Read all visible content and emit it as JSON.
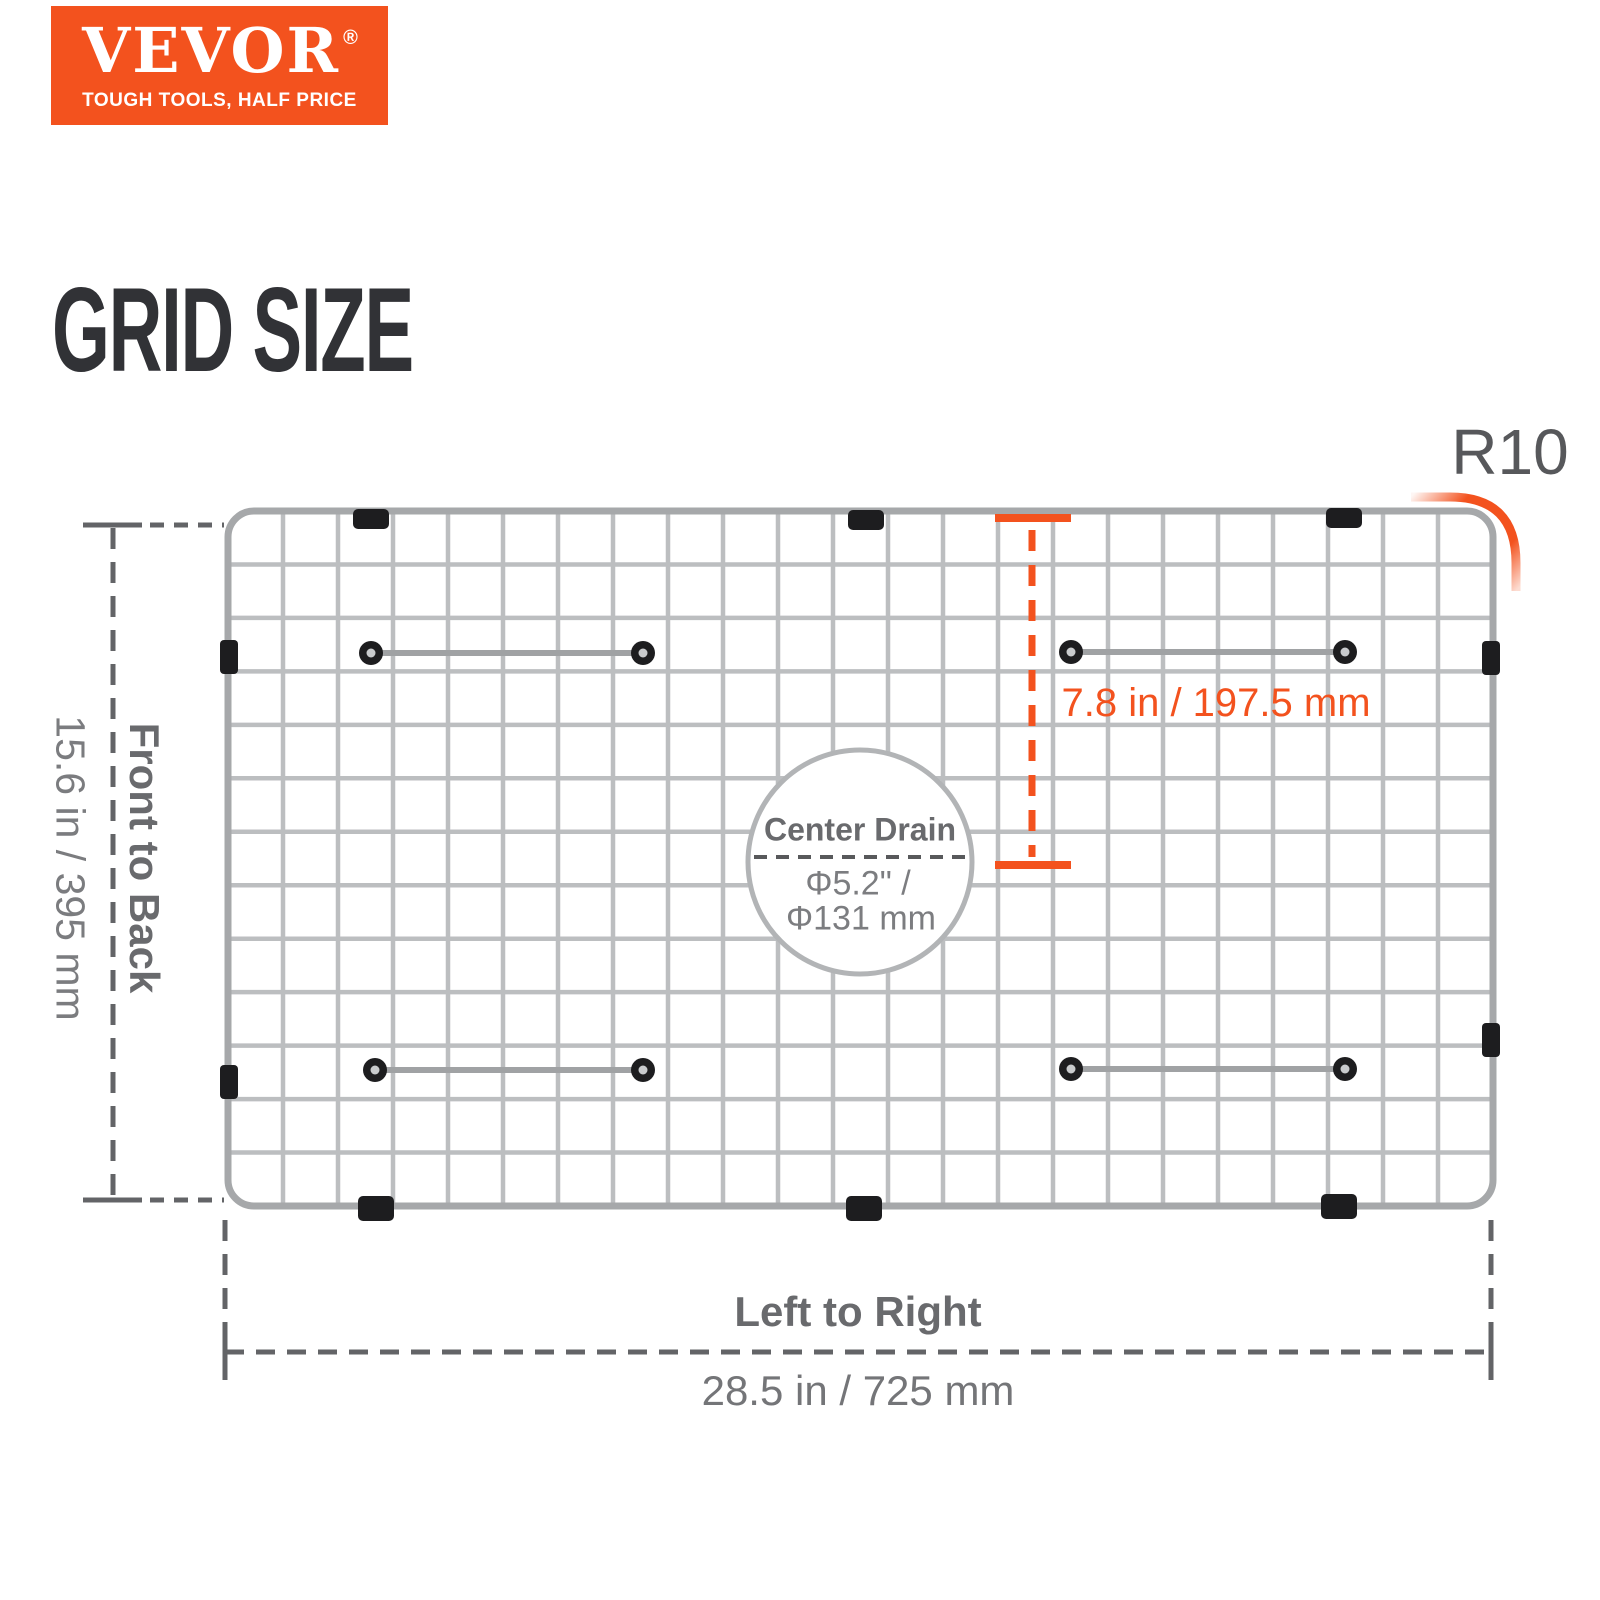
{
  "brand": {
    "logo_text": "VEVOR",
    "registered_mark": "®",
    "tagline": "TOUGH TOOLS, HALF PRICE"
  },
  "page": {
    "title": "GRID SIZE"
  },
  "diagram": {
    "corner_radius_label": "R10",
    "front_to_back_label": "Front to Back",
    "front_to_back_value": "15.6 in / 395 mm",
    "left_to_right_label": "Left to Right",
    "left_to_right_value": "28.5 in / 725 mm",
    "drain_offset_value": "7.8 in / 197.5 mm",
    "center_drain_label": "Center Drain",
    "center_drain_diameter_in": "Φ5.2\" /",
    "center_drain_diameter_mm": "Φ131 mm"
  },
  "colors": {
    "brand_orange": "#F3521E",
    "accent_orange": "#F3521E",
    "heading_dark": "#313236",
    "label_gray": "#696A6D",
    "value_gray": "#7B7C7F",
    "radius_label_gray": "#57585B",
    "dim_line_gray": "#636467",
    "wire_silver": "#B5B7B9",
    "clip_black": "#1D1D1F"
  }
}
